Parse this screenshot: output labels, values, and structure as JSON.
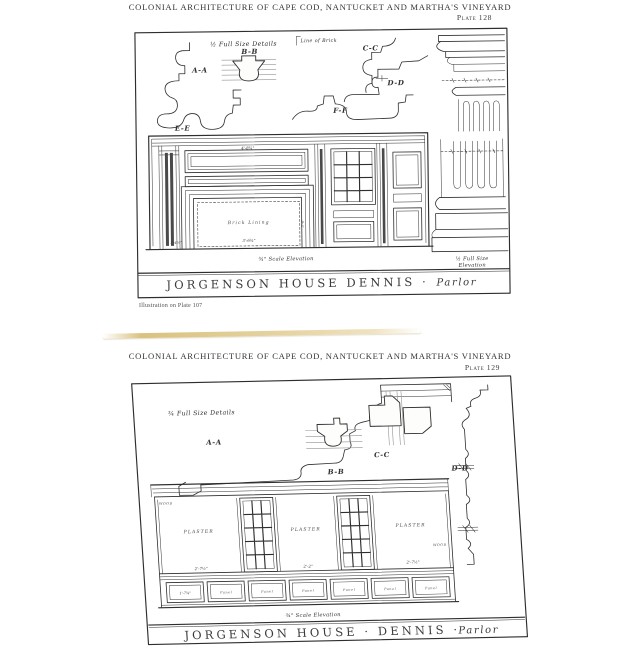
{
  "colors": {
    "ink": "#2e2e2e",
    "paper": "#fdfdfb",
    "page_edge": "#e6d5a4"
  },
  "page1": {
    "header": "COLONIAL ARCHITECTURE OF CAPE COD, NANTUCKET AND MARTHA'S VINEYARD",
    "plate_no": "Plate 128",
    "details_caption": "½ Full Size Details",
    "line_of_brick": "Line of Brick",
    "sections": {
      "aa": "A-A",
      "bb": "B-B",
      "cc": "C-C",
      "dd": "D-D",
      "ee": "E-E",
      "ff": "F-F"
    },
    "elevation": {
      "brick_lining": "Brick Lining",
      "dim_top": "4'-8¾\"",
      "dim_opening_width": "3'-6¾\"",
      "dim_opening_height": "3'-0\"",
      "dim_hearth": "1'-4½\"",
      "scale_caption": "¾\" Scale Elevation"
    },
    "full_size_caption_line1": "½ Full Size",
    "full_size_caption_line2": "Elevation",
    "title": "JORGENSON HOUSE DENNIS ·",
    "room": "Parlor",
    "footnote": "Illustration on Plate 107"
  },
  "page2": {
    "header": "COLONIAL ARCHITECTURE OF CAPE COD, NANTUCKET AND MARTHA'S VINEYARD",
    "plate_no": "Plate 129",
    "details_caption": "¾ Full Size Details",
    "sections": {
      "aa": "A-A",
      "bb": "B-B",
      "cc": "C-C",
      "dd": "D-D"
    },
    "elevation": {
      "plaster": "PLASTER",
      "wood": "WOOD",
      "panel": "Panel",
      "dim_bay_left": "2'-7½\"",
      "dim_bay_mid": "2'-2\"",
      "dim_bay_right": "2'-7½\"",
      "dim_panel_first": "1'-7¾\"",
      "scale_caption": "¾\" Scale Elevation"
    },
    "title": "JORGENSON HOUSE · DENNIS ·",
    "room": "Parlor"
  }
}
